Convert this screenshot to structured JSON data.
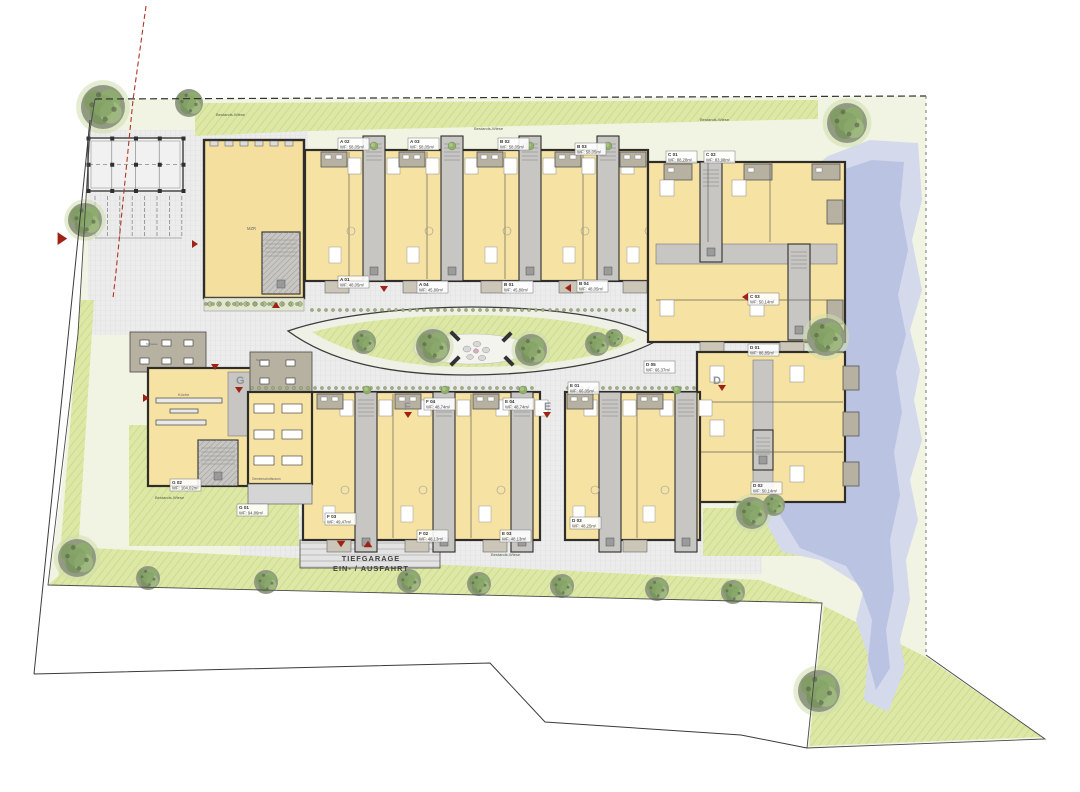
{
  "plan": {
    "garage": {
      "line1": "TIEFGARAGE",
      "line2": "EIN- / AUSFAHRT"
    },
    "colors": {
      "accent_red": "#a02215",
      "water_outer": "#d4d9ec",
      "water_inner": "#b9c2e3",
      "grass": "#dde8a7",
      "room_yellow": "#f6e2a2",
      "wall": "#2f2d2a",
      "terrace_tan": "#b7b1a2"
    },
    "units": [
      {
        "id": "A 02",
        "area": "WF: 58,05m²",
        "x": 338,
        "y": 138
      },
      {
        "id": "A 03",
        "area": "WF: 58,05m²",
        "x": 408,
        "y": 138
      },
      {
        "id": "B 02",
        "area": "WF: 58,05m²",
        "x": 498,
        "y": 138
      },
      {
        "id": "B 03",
        "area": "WF: 58,05m²",
        "x": 575,
        "y": 143
      },
      {
        "id": "C 01",
        "area": "WF: 88,28m²",
        "x": 666,
        "y": 151
      },
      {
        "id": "C 02",
        "area": "WF: 83,98m²",
        "x": 704,
        "y": 151
      },
      {
        "id": "A 01",
        "area": "WF: 48,05m²",
        "x": 338,
        "y": 276
      },
      {
        "id": "A 04",
        "area": "WF: 45,80m²",
        "x": 417,
        "y": 281
      },
      {
        "id": "B 01",
        "area": "WF: 45,80m²",
        "x": 502,
        "y": 281
      },
      {
        "id": "B 04",
        "area": "WF: 48,05m²",
        "x": 577,
        "y": 280
      },
      {
        "id": "C 03",
        "area": "WF: 50,14m²",
        "x": 748,
        "y": 293
      },
      {
        "id": "D 01",
        "area": "WF: 86,85m²",
        "x": 748,
        "y": 344
      },
      {
        "id": "D 05",
        "area": "WF: 66,37m²",
        "x": 644,
        "y": 361
      },
      {
        "id": "E 01",
        "area": "WF: 66,05m²",
        "x": 568,
        "y": 382
      },
      {
        "id": "F 04",
        "area": "WF: 48,74m²",
        "x": 424,
        "y": 398
      },
      {
        "id": "E 04",
        "area": "WF: 48,74m²",
        "x": 503,
        "y": 398
      },
      {
        "id": "G 02",
        "area": "WF: 104,02m²",
        "x": 170,
        "y": 479
      },
      {
        "id": "G 01",
        "area": "WF: 94,86m²",
        "x": 237,
        "y": 504
      },
      {
        "id": "F 03",
        "area": "WF: 49,47m²",
        "x": 325,
        "y": 513
      },
      {
        "id": "F 02",
        "area": "WF: 48,13m²",
        "x": 417,
        "y": 530
      },
      {
        "id": "E 03",
        "area": "WF: 48,13m²",
        "x": 500,
        "y": 530
      },
      {
        "id": "D 03",
        "area": "WF: 48,25m²",
        "x": 570,
        "y": 517
      },
      {
        "id": "D 02",
        "area": "WF: 50,14m²",
        "x": 751,
        "y": 482
      }
    ],
    "building_letters": [
      {
        "t": "G",
        "x": 236,
        "y": 384
      },
      {
        "t": "F",
        "x": 404,
        "y": 410
      },
      {
        "t": "E",
        "x": 544,
        "y": 410
      },
      {
        "t": "D",
        "x": 713,
        "y": 384
      }
    ],
    "strip_labels": [
      {
        "t": "Bestands-Wiese",
        "x": 216,
        "y": 116
      },
      {
        "t": "Bestands-Wiese",
        "x": 474,
        "y": 130
      },
      {
        "t": "Bestands-Wiese",
        "x": 700,
        "y": 121
      },
      {
        "t": "Bestands-Wiese",
        "x": 491,
        "y": 556
      },
      {
        "t": "Bestands-Wiese",
        "x": 155,
        "y": 499
      }
    ],
    "room_labels": [
      {
        "t": "MZR",
        "x": 247,
        "y": 230,
        "fs": 4.2
      },
      {
        "t": "Küche",
        "x": 178,
        "y": 396,
        "fs": 4
      },
      {
        "t": "Gemeinschaftsraum",
        "x": 252,
        "y": 480,
        "fs": 3.2
      },
      {
        "t": "Terrasse",
        "x": 146,
        "y": 345,
        "fs": 3
      },
      {
        "t": "Terrasse",
        "x": 256,
        "y": 361,
        "fs": 3
      }
    ],
    "trees": [
      {
        "x": 103,
        "y": 107,
        "r": 22,
        "h": 1
      },
      {
        "x": 189,
        "y": 103,
        "r": 14,
        "h": 0
      },
      {
        "x": 85,
        "y": 220,
        "r": 17,
        "h": 1
      },
      {
        "x": 847,
        "y": 123,
        "r": 20,
        "h": 1
      },
      {
        "x": 826,
        "y": 337,
        "r": 19,
        "h": 1
      },
      {
        "x": 752,
        "y": 513,
        "r": 16,
        "h": 1
      },
      {
        "x": 774,
        "y": 505,
        "r": 11,
        "h": 0
      },
      {
        "x": 364,
        "y": 342,
        "r": 12,
        "h": 0
      },
      {
        "x": 433,
        "y": 346,
        "r": 17,
        "h": 1
      },
      {
        "x": 531,
        "y": 350,
        "r": 16,
        "h": 1
      },
      {
        "x": 597,
        "y": 344,
        "r": 12,
        "h": 0
      },
      {
        "x": 614,
        "y": 338,
        "r": 9,
        "h": 0
      },
      {
        "x": 77,
        "y": 558,
        "r": 19,
        "h": 1
      },
      {
        "x": 148,
        "y": 578,
        "r": 12,
        "h": 0
      },
      {
        "x": 266,
        "y": 582,
        "r": 12,
        "h": 0
      },
      {
        "x": 409,
        "y": 581,
        "r": 12,
        "h": 0
      },
      {
        "x": 479,
        "y": 584,
        "r": 12,
        "h": 0
      },
      {
        "x": 562,
        "y": 586,
        "r": 12,
        "h": 0
      },
      {
        "x": 657,
        "y": 589,
        "r": 12,
        "h": 0
      },
      {
        "x": 733,
        "y": 592,
        "r": 12,
        "h": 0
      },
      {
        "x": 819,
        "y": 691,
        "r": 21,
        "h": 1
      }
    ],
    "shrubs": [
      {
        "x": 374,
        "y": 146
      },
      {
        "x": 452,
        "y": 146
      },
      {
        "x": 530,
        "y": 146
      },
      {
        "x": 608,
        "y": 146
      },
      {
        "x": 367,
        "y": 390
      },
      {
        "x": 445,
        "y": 390
      },
      {
        "x": 523,
        "y": 390
      },
      {
        "x": 677,
        "y": 390
      }
    ],
    "arrows": [
      {
        "x": 64,
        "y": 237,
        "d": "E",
        "s": 1.6
      },
      {
        "x": 196,
        "y": 243,
        "d": "E",
        "s": 1
      },
      {
        "x": 276,
        "y": 305,
        "d": "N",
        "s": 1
      },
      {
        "x": 215,
        "y": 367,
        "d": "S",
        "s": 1
      },
      {
        "x": 239,
        "y": 390,
        "d": "S",
        "s": 1
      },
      {
        "x": 147,
        "y": 397,
        "d": "E",
        "s": 1
      },
      {
        "x": 384,
        "y": 289,
        "d": "S",
        "s": 1
      },
      {
        "x": 569,
        "y": 287,
        "d": "W",
        "s": 1
      },
      {
        "x": 746,
        "y": 296,
        "d": "W",
        "s": 1
      },
      {
        "x": 722,
        "y": 388,
        "d": "S",
        "s": 1
      },
      {
        "x": 408,
        "y": 415,
        "d": "S",
        "s": 1
      },
      {
        "x": 547,
        "y": 415,
        "d": "S",
        "s": 1
      },
      {
        "x": 341,
        "y": 544,
        "d": "S",
        "s": 1.1
      },
      {
        "x": 368,
        "y": 544,
        "d": "N",
        "s": 1.1
      }
    ],
    "stones": [
      {
        "x": 467,
        "y": 349,
        "rx": 4,
        "ry": 3,
        "pink": 0
      },
      {
        "x": 477,
        "y": 344,
        "rx": 4,
        "ry": 2.6,
        "pink": 0
      },
      {
        "x": 486,
        "y": 350,
        "rx": 3.6,
        "ry": 2.8,
        "pink": 0
      },
      {
        "x": 470,
        "y": 357,
        "rx": 3.4,
        "ry": 2.5,
        "pink": 0
      },
      {
        "x": 482,
        "y": 358,
        "rx": 3.8,
        "ry": 2.6,
        "pink": 0
      },
      {
        "x": 476,
        "y": 351,
        "rx": 2.6,
        "ry": 2.2,
        "pink": 1
      }
    ]
  }
}
